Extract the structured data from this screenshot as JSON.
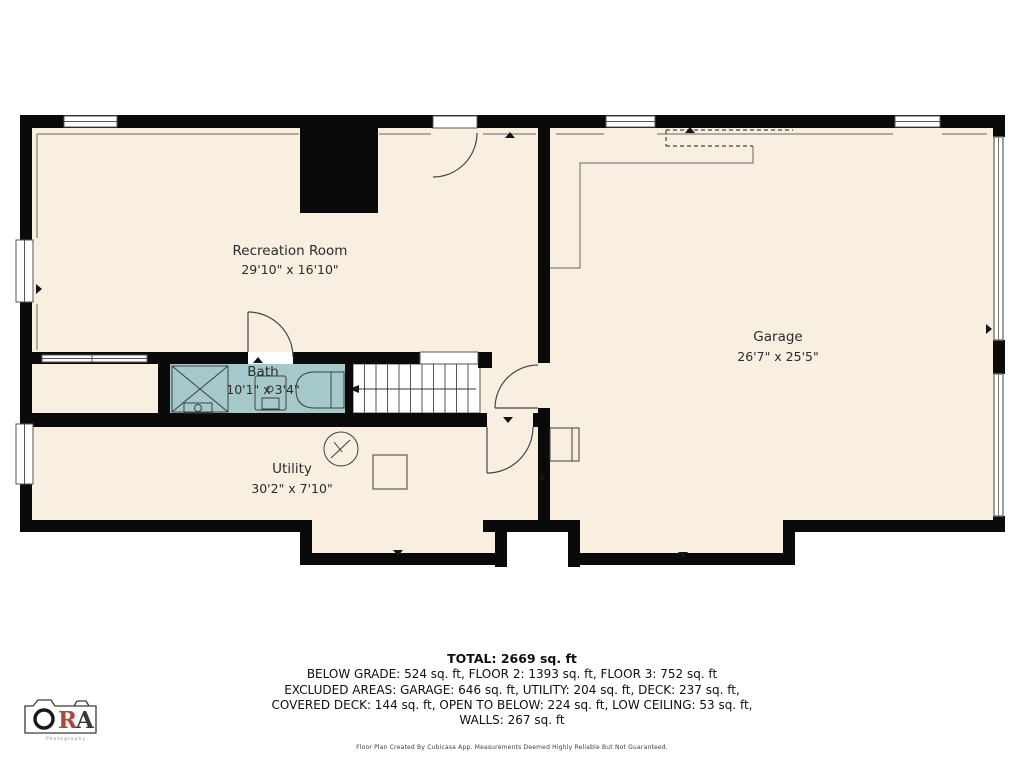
{
  "palette": {
    "floor": "#f9efe0",
    "bath": "#a5c9ca",
    "wall": "#0a0a0a",
    "thin_line": "#555555",
    "logo_red": "#ad473d",
    "logo_dark": "#3a3a3a"
  },
  "rooms": [
    {
      "name": "Recreation Room",
      "dimensions": "29'10\" x 16'10\""
    },
    {
      "name": "Bath",
      "dimensions": "10'1\" x 3'4\""
    },
    {
      "name": "Utility",
      "dimensions": "30'2\" x 7'10\""
    },
    {
      "name": "Garage",
      "dimensions": "26'7\" x 25'5\""
    }
  ],
  "summary": {
    "total": "TOTAL: 2669 sq. ft",
    "line2": "BELOW GRADE: 524 sq. ft, FLOOR 2: 1393 sq. ft, FLOOR 3: 752 sq. ft",
    "line3": "EXCLUDED AREAS: GARAGE: 646 sq. ft, UTILITY: 204 sq. ft, DECK: 237 sq. ft,",
    "line4": "COVERED DECK: 144 sq. ft, OPEN TO BELOW: 224 sq. ft, LOW CEILING: 53 sq. ft,",
    "line5": "WALLS: 267 sq. ft"
  },
  "footer": {
    "disclaimer": "Floor Plan Created By Cubicasa App. Measurements Deemed Highly Reliable But Not Guaranteed."
  },
  "logo": {
    "letter_r": "R",
    "letter_a": "A",
    "subtitle": "Photography"
  }
}
